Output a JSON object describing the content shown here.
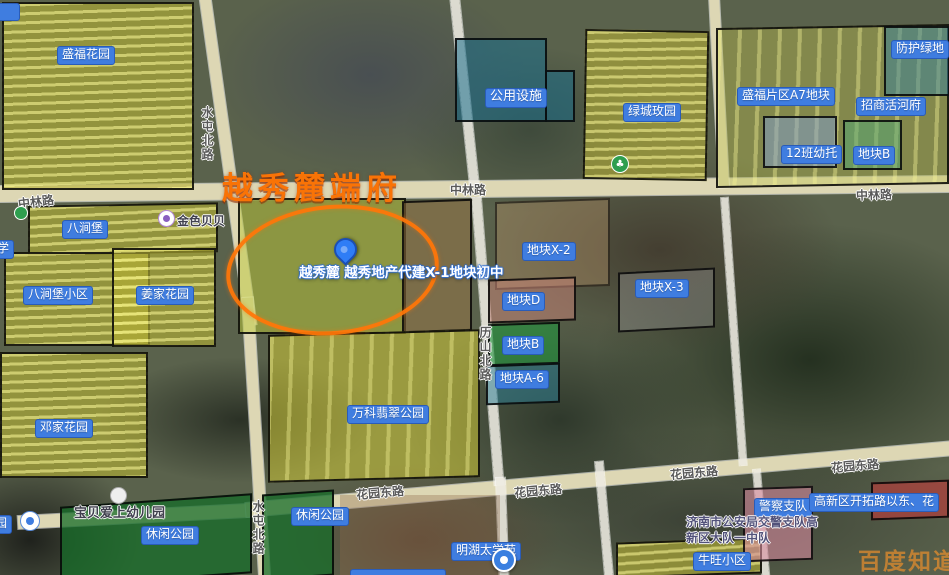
{
  "watermark_text": "百度知道",
  "annotation": {
    "title": "越秀麓端府",
    "pin_label": "越秀麓 越秀地产代建X-1地块初中"
  },
  "blue_labels": [
    "盛福花园",
    "公用设施",
    "绿城玫园",
    "盛福片区A7地块",
    "招商活河府",
    "防护绿地",
    "12班幼托",
    "地块B",
    "八涧堡",
    "八涧堡小区",
    "姜家花园",
    "邓家花园",
    "地块X-2",
    "地块D",
    "地块X-3",
    "地块B",
    "地块A-6",
    "万科翡翠公园",
    "休闲公园",
    "休闲公园",
    "明湖太学苑",
    "牛旺小区",
    "警察支队",
    "高新区开拓路以东、花",
    "学",
    "园"
  ],
  "road_labels": [
    "中林路",
    "中林路",
    "中林路",
    "花园东路",
    "花园东路",
    "花园东路",
    "花园东路",
    "水屯北路",
    "水屯北路",
    "历山北路"
  ],
  "poi_labels": [
    "金色贝贝",
    "宝贝爱上幼儿园",
    "济南市公安局交警支队高",
    "新区大队一中队"
  ],
  "icons": {
    "tree_glyph": "♣"
  },
  "colors": {
    "parcel_yellow": "rgba(208,202,58,0.52)",
    "parcel_teal": "rgba(28,112,140,0.55)",
    "parcel_green": "rgba(34,150,62,0.6)",
    "parcel_pink": "rgba(216,140,160,0.6)",
    "parcel_red": "rgba(195,58,58,0.6)",
    "annotation_orange": "#ff7608",
    "label_blue": "#3f7de0"
  }
}
